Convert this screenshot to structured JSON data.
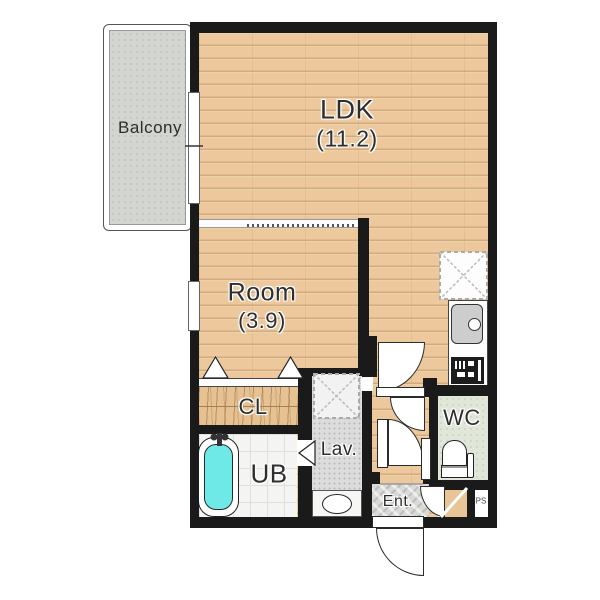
{
  "title": "apartment-floor-plan",
  "rooms": {
    "ldk": {
      "label": "LDK",
      "size": "(11.2)"
    },
    "room": {
      "label": "Room",
      "size": "(3.9)"
    },
    "balcony": {
      "label": "Balcony"
    },
    "closet": {
      "label": "CL"
    },
    "bath": {
      "label": "UB"
    },
    "lavatory": {
      "label": "Lav."
    },
    "wc": {
      "label": "WC"
    },
    "entrance": {
      "label": "Ent."
    },
    "pipe_space": {
      "label": "PS"
    }
  },
  "fixtures": [
    "bathtub",
    "kitchen-sink",
    "gas-stove",
    "refrigerator-space",
    "washing-machine-space",
    "washbasin",
    "toilet",
    "shoe-cabinet",
    "front-door",
    "sliding-closet-doors",
    "accordion-partition",
    "windows"
  ],
  "colors": {
    "wall": "#1a1a1a",
    "wood_floor": "#ecc89c",
    "wood_line": "#9e6734",
    "balcony_floor": "#d3d5d0",
    "bath_floor": "#f4f4f2",
    "lavatory_floor": "#dcdcdc",
    "wc_floor": "#e0e6d8",
    "entrance_floor": "#d9d9d7",
    "bathtub": "#6fe9e7",
    "counter": "#fdfdfd",
    "sink": "#cdcdcd",
    "stove": "#1c1c1c"
  }
}
